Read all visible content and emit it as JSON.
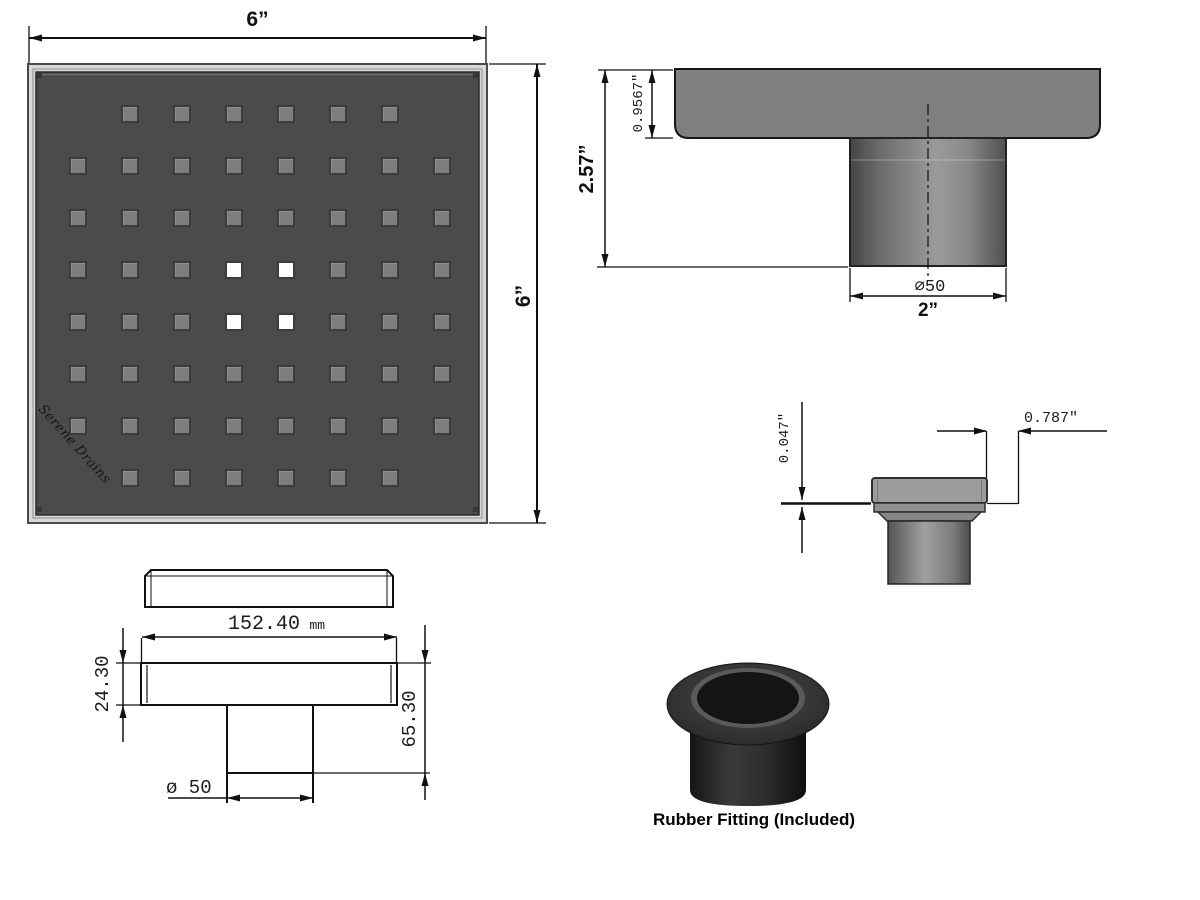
{
  "drawing": {
    "top_view": {
      "width_label": "6”",
      "height_label": "6”",
      "logo": "Serene Drains",
      "grid": {
        "rows": 8,
        "cols": 8,
        "origin_x": 69,
        "origin_y": 105,
        "pitch": 52,
        "size": 18,
        "missing": [
          [
            0,
            0
          ],
          [
            0,
            7
          ],
          [
            7,
            0
          ],
          [
            7,
            7
          ]
        ],
        "white": [
          [
            3,
            3
          ],
          [
            3,
            4
          ],
          [
            4,
            3
          ],
          [
            4,
            4
          ]
        ]
      },
      "colors": {
        "face": "#4b4b4b",
        "hole": "#7d7d7d",
        "hole_open": "#ffffff",
        "frame": "#d8d8d8"
      }
    },
    "section_view": {
      "total_height": "2.57”",
      "plate_thickness": "0.9567\"",
      "pipe_diameter": "∅50",
      "pipe_width": "2”"
    },
    "detail_view": {
      "lip": "0.047\"",
      "offset": "0.787\""
    },
    "mm_view": {
      "width_value": "152.40",
      "width_unit": "mm",
      "body_height": "24.30",
      "total_height": "65.30",
      "pipe_diameter": "ø 50"
    },
    "rubber_fitting": {
      "caption": "Rubber Fitting (Included)"
    }
  }
}
